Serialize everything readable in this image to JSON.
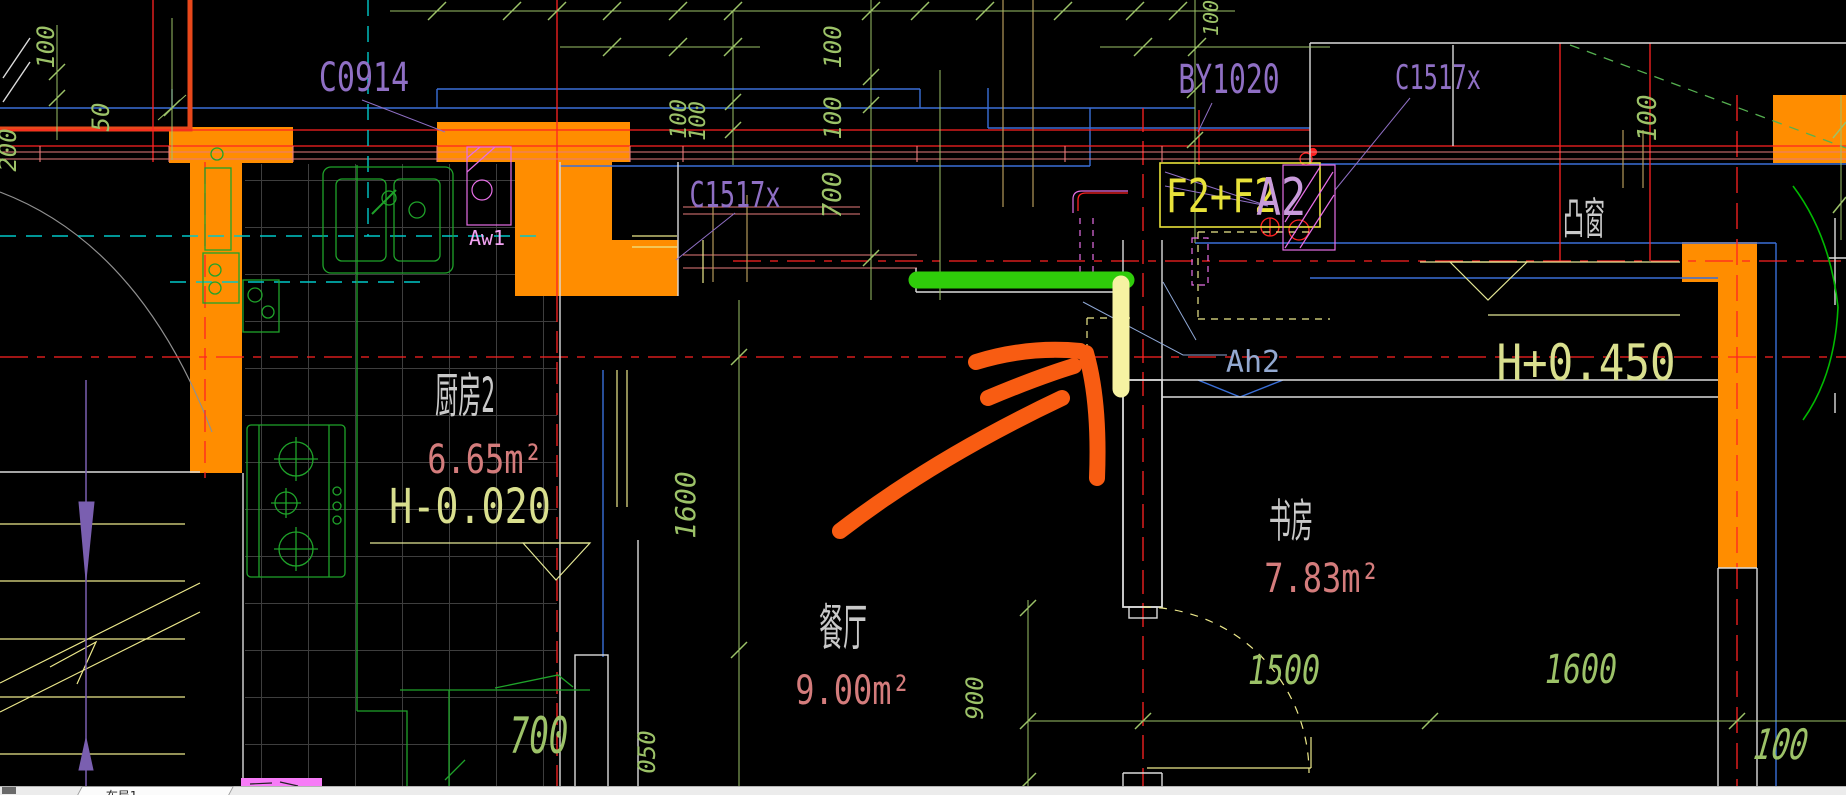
{
  "ui": {
    "layout_tab": "布局1"
  },
  "rooms": {
    "kitchen": {
      "name": "厨房2",
      "area": "6.65m²",
      "level": "H-0.020"
    },
    "dining": {
      "name": "餐厅",
      "area": "9.00m²"
    },
    "study": {
      "name": "书房",
      "area": "7.83m²"
    },
    "bay": {
      "name": "凸窗",
      "level": "H+0.450"
    }
  },
  "labels": {
    "window_c0914": "C0914",
    "window_c1517_left": "C1517x",
    "window_by1020": "BY1020",
    "window_c1517_right": "C1517x",
    "door_f2": "F2+F2",
    "door_a2": "A2",
    "fixture_aw1": "Aw1",
    "fixture_ah2": "Ah2"
  },
  "dims": {
    "d100_left": "100",
    "d50_left": "50",
    "d200_left": "200",
    "d100_win_a": "100",
    "d100_win_b": "100",
    "d100_col_a": "100",
    "d100_col_b": "100",
    "d700_col": "700",
    "d100_top_right": "100",
    "d100_far_right": "100",
    "d1600_dining": "1600",
    "d050_dining": "050",
    "d900_door": "900",
    "d700_kitchen": "700",
    "d1500_study": "1500",
    "d1600_bay": "1600",
    "d100_corner": "100"
  },
  "colors": {
    "background": "#000000",
    "wall_fill": "#FF8D00",
    "highlight_green": "#2FCC0A",
    "highlight_yellow": "#F6F2A2",
    "annotation_arrow": "#F85C12",
    "dimension_green": "#9CC268",
    "axis_red": "#FF2222",
    "window_blue": "#3A6FD8",
    "label_purple": "#8F6FC4",
    "area_pink": "#D47C7C",
    "level_yellow_green": "#D9DF8E",
    "fixture_green": "#1FA32A",
    "fixture_magenta": "#E66FE6",
    "leader_blue": "#8FA8D6",
    "centerline_cyan": "#00C8C8"
  }
}
